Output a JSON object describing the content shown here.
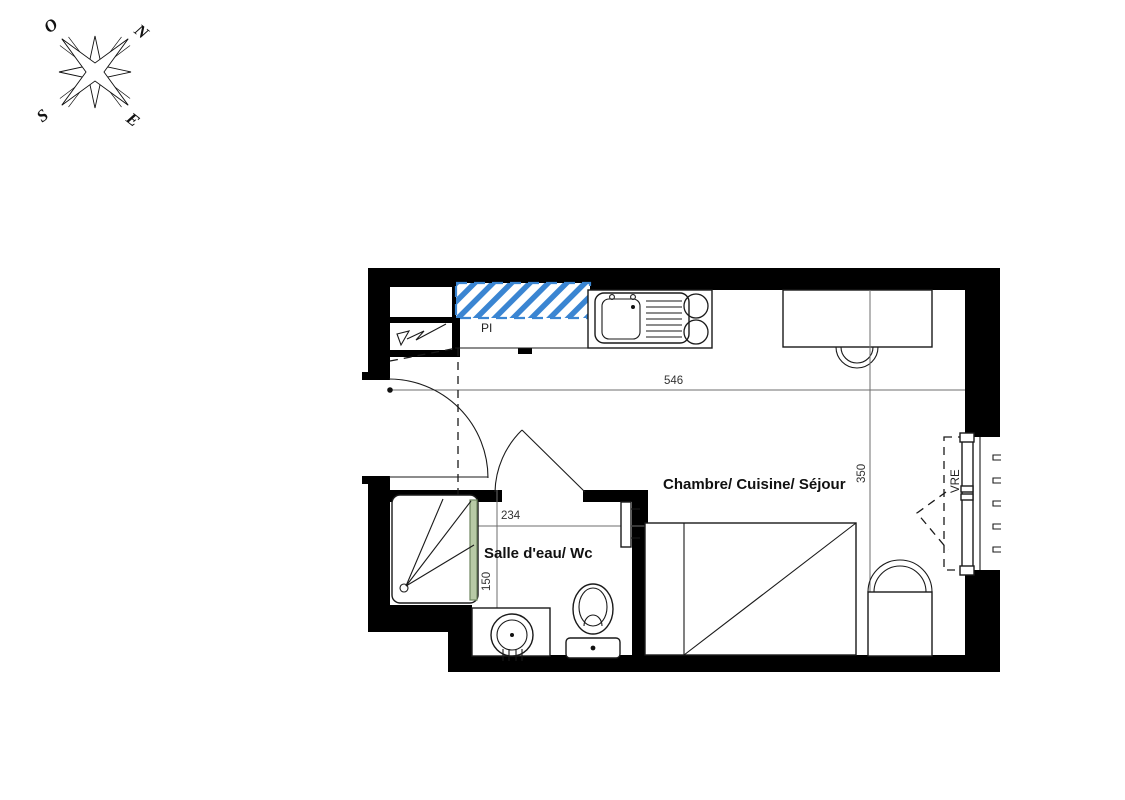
{
  "compass": {
    "west": "O",
    "north": "N",
    "south": "S",
    "east": "E"
  },
  "rooms": {
    "main_label": "Chambre/ Cuisine/ Séjour",
    "bathroom_label": "Salle d'eau/ Wc"
  },
  "annotations": {
    "closet_label": "PI",
    "window_label": "VRE"
  },
  "dimensions": {
    "main_width_cm": "546",
    "main_height_cm": "350",
    "bath_width_cm": "234",
    "bath_height_cm": "150"
  },
  "colors": {
    "wall": "#000000",
    "line": "#1a1a1a",
    "hatch_blue": "#3a85d2",
    "glass_green": "#b8caa6"
  }
}
